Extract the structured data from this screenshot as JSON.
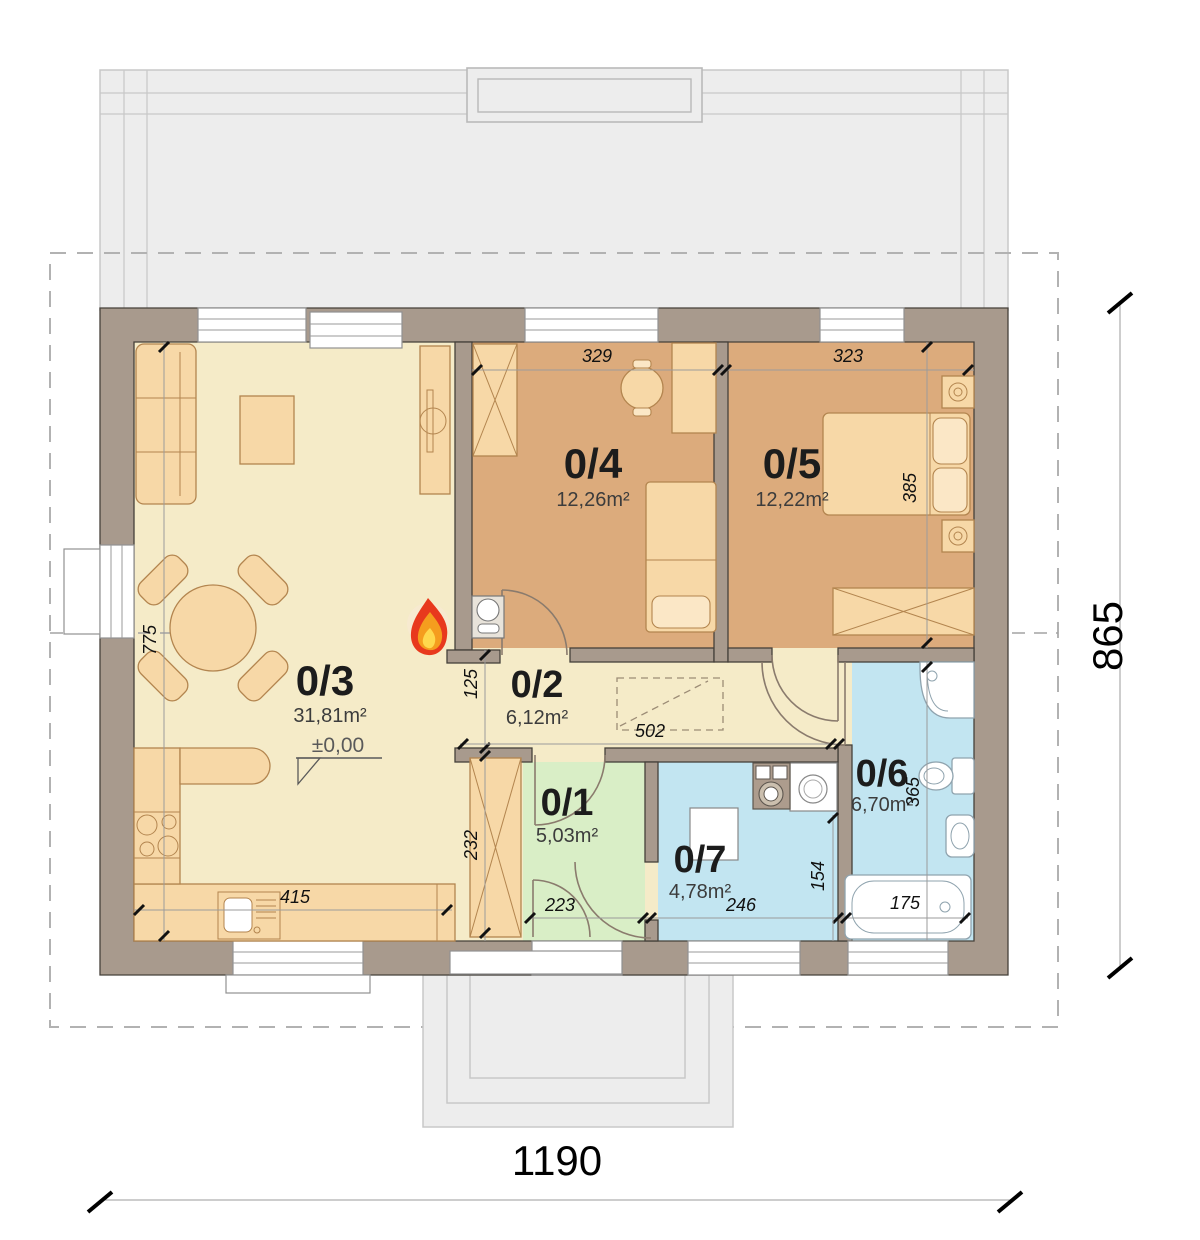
{
  "plan": {
    "type": "single-storey house floor plan",
    "colors": {
      "floor_living": "#f5ebc8",
      "floor_bedrooms": "#dcab7c",
      "floor_entry": "#d9eec6",
      "floor_wet_rooms": "#c2e5f1",
      "walls": "#a89a8d",
      "roof_outline": "#ededed",
      "furniture": "#f7d8a7",
      "flame_red": "#e8391d",
      "flame_orange": "#f59d1e",
      "flame_yellow": "#ffd84d"
    }
  },
  "rooms": [
    {
      "id": "0/1",
      "area": "5,03m²"
    },
    {
      "id": "0/2",
      "area": "6,12m²"
    },
    {
      "id": "0/3",
      "area": "31,81m²",
      "level": "±0,00"
    },
    {
      "id": "0/4",
      "area": "12,26m²"
    },
    {
      "id": "0/5",
      "area": "12,22m²"
    },
    {
      "id": "0/6",
      "area": "6,70m²"
    },
    {
      "id": "0/7",
      "area": "4,78m²"
    }
  ],
  "dims": {
    "overall_width": "1190",
    "overall_height": "865",
    "d329": "329",
    "d323": "323",
    "d385": "385",
    "d775": "775",
    "d125": "125",
    "d502": "502",
    "d232": "232",
    "d223": "223",
    "d246": "246",
    "d154": "154",
    "d365": "365",
    "d175": "175",
    "d415": "415"
  }
}
